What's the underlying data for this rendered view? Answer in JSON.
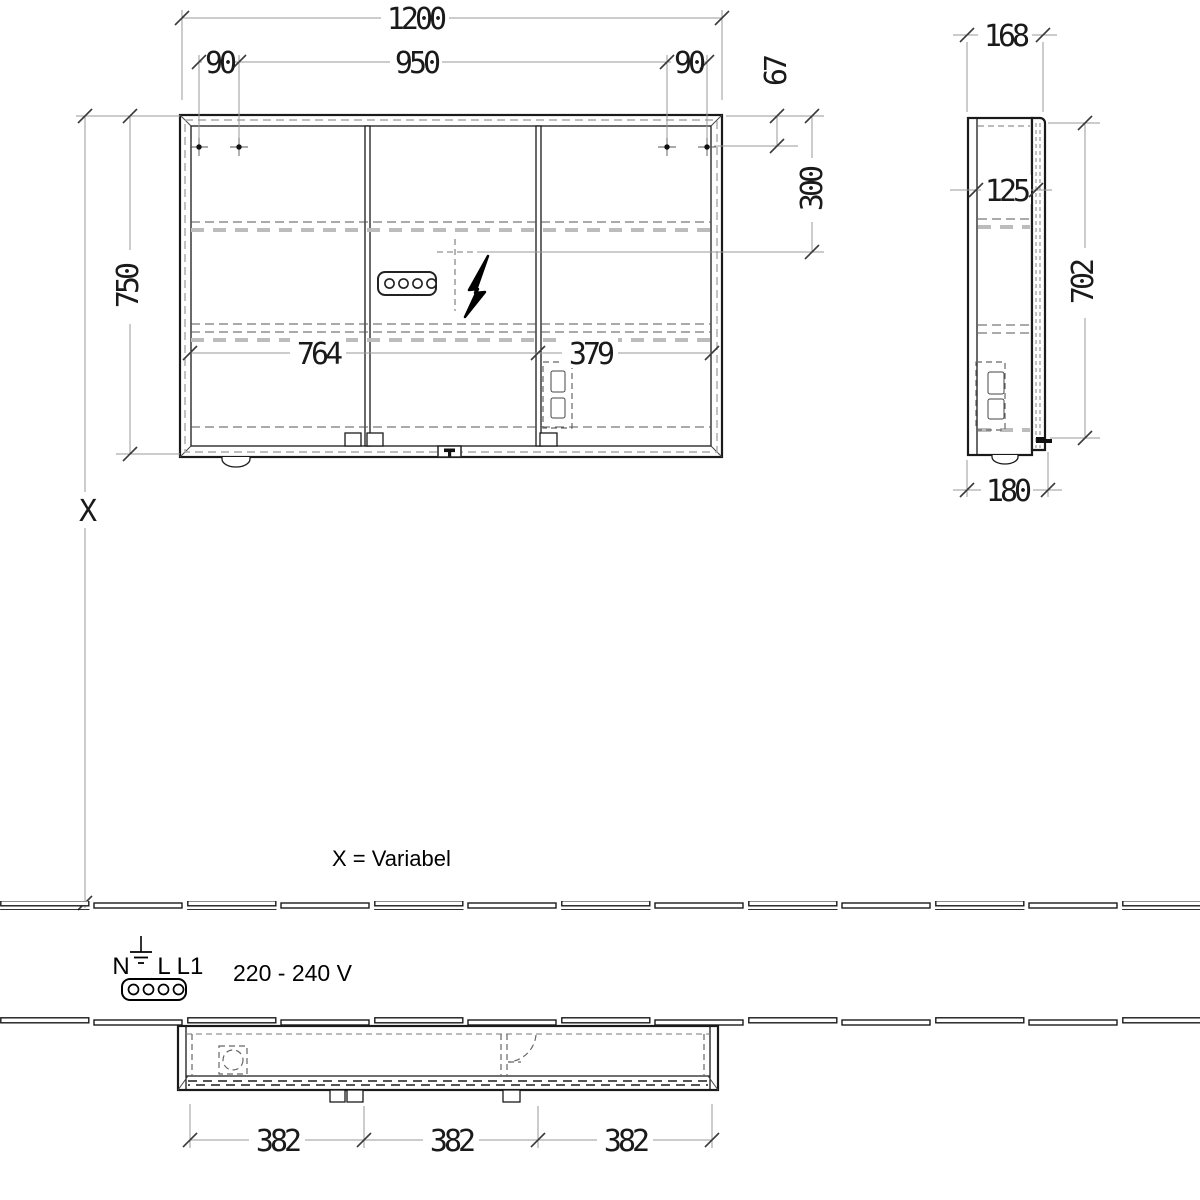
{
  "front": {
    "overall_width": "1200",
    "offset_left": "90",
    "hole_spacing": "950",
    "offset_right": "90",
    "top_to_holes": "67",
    "top_to_outlet": "300",
    "height": "750",
    "left_section": "764",
    "right_section": "379",
    "wall_distance": "X"
  },
  "side": {
    "depth_top": "168",
    "inner_depth": "125",
    "door_height": "702",
    "depth_bottom": "180"
  },
  "plan": {
    "door_1": "382",
    "door_2": "382",
    "door_3": "382"
  },
  "legend": {
    "variable_note": "X = Variabel",
    "terminal_n": "N",
    "terminal_l": "L",
    "terminal_l1": "L1",
    "voltage": "220 - 240 V"
  },
  "colors": {
    "outline": "#1a1a1a",
    "dimension_line": "#999999",
    "light_dash": "#bcbcbc",
    "text": "#1a1a1a"
  }
}
